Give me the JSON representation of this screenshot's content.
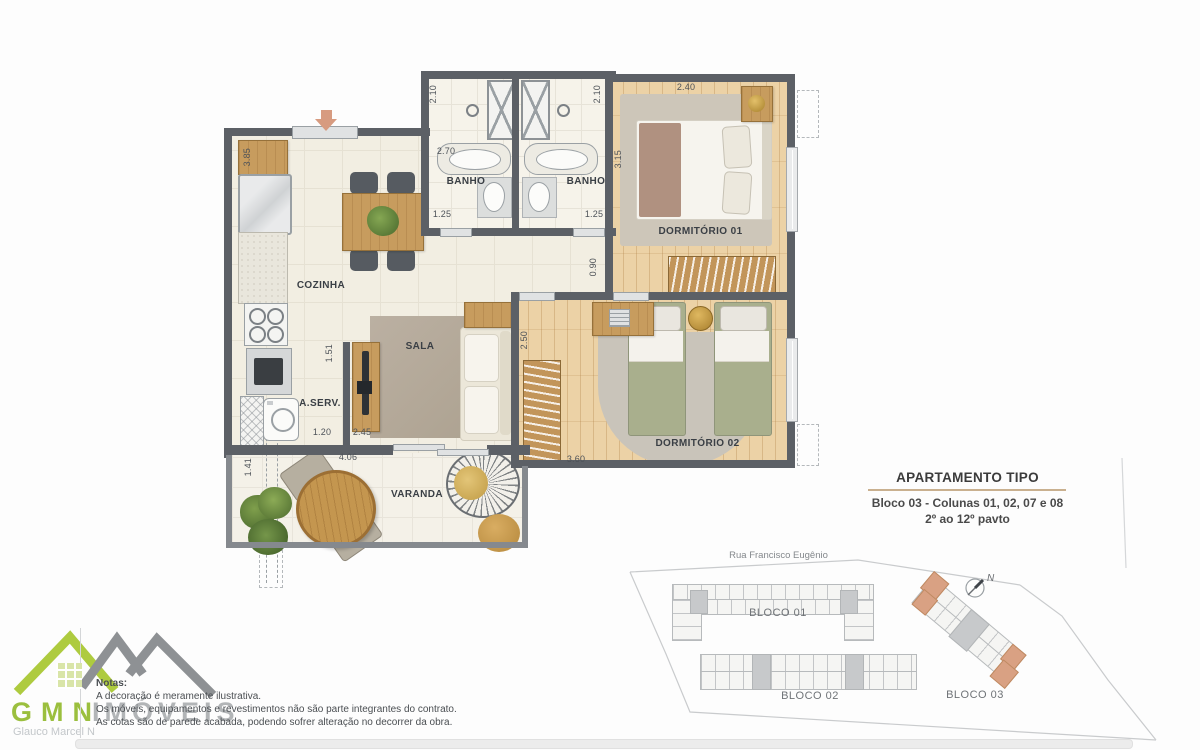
{
  "plan": {
    "rooms": {
      "cozinha": "COZINHA",
      "sala": "SALA",
      "aserv": "A.SERV.",
      "banho_left": "BANHO",
      "banho_right": "BANHO",
      "dorm1": "DORMITÓRIO 01",
      "dorm2": "DORMITÓRIO 02",
      "varanda": "VARANDA"
    },
    "dims": {
      "kitchen_top": "2.70",
      "bath_left_depth": "2.10",
      "bath_right_depth": "2.10",
      "dorm1_width": "2.40",
      "dorm1_depth": "3.15",
      "bath_left_width": "1.25",
      "bath_right_width": "1.25",
      "hall_width": "0.90",
      "kitchen_depth": "3.85",
      "dorm2_depth": "2.50",
      "dorm2_width": "3.60",
      "sala_pass": "1.51",
      "aserv_width": "1.20",
      "sala_width": "2.45",
      "varanda_width": "4.06",
      "varanda_depth": "1.41"
    },
    "colors": {
      "wall": "#5c6066",
      "wood": "#c79c5e",
      "entry_arrow": "#d79b80"
    }
  },
  "info": {
    "title": "APARTAMENTO TIPO",
    "subtitle1": "Bloco 03 - Colunas 01, 02, 07 e 08",
    "subtitle2": "2º ao 12º pavto"
  },
  "site": {
    "street": "Rua Francisco Eugênio",
    "bloco01": "BLOCO 01",
    "bloco02": "BLOCO 02",
    "bloco03": "BLOCO 03",
    "north": "N",
    "highlight_color": "#d9a183"
  },
  "logo": {
    "name": "GMN",
    "name2": "IMÓVEIS",
    "agent": "Glauco Marcel N",
    "green": "#a6c43e",
    "gray": "#8e9194"
  },
  "notes": {
    "heading": "Notas:",
    "line1": "A decoração é meramente ilustrativa.",
    "line2": "Os móveis, equipamentos e revestimentos não são parte integrantes do contrato.",
    "line3": "As cotas são de parede acabada, podendo sofrer alteração no decorrer da obra."
  }
}
